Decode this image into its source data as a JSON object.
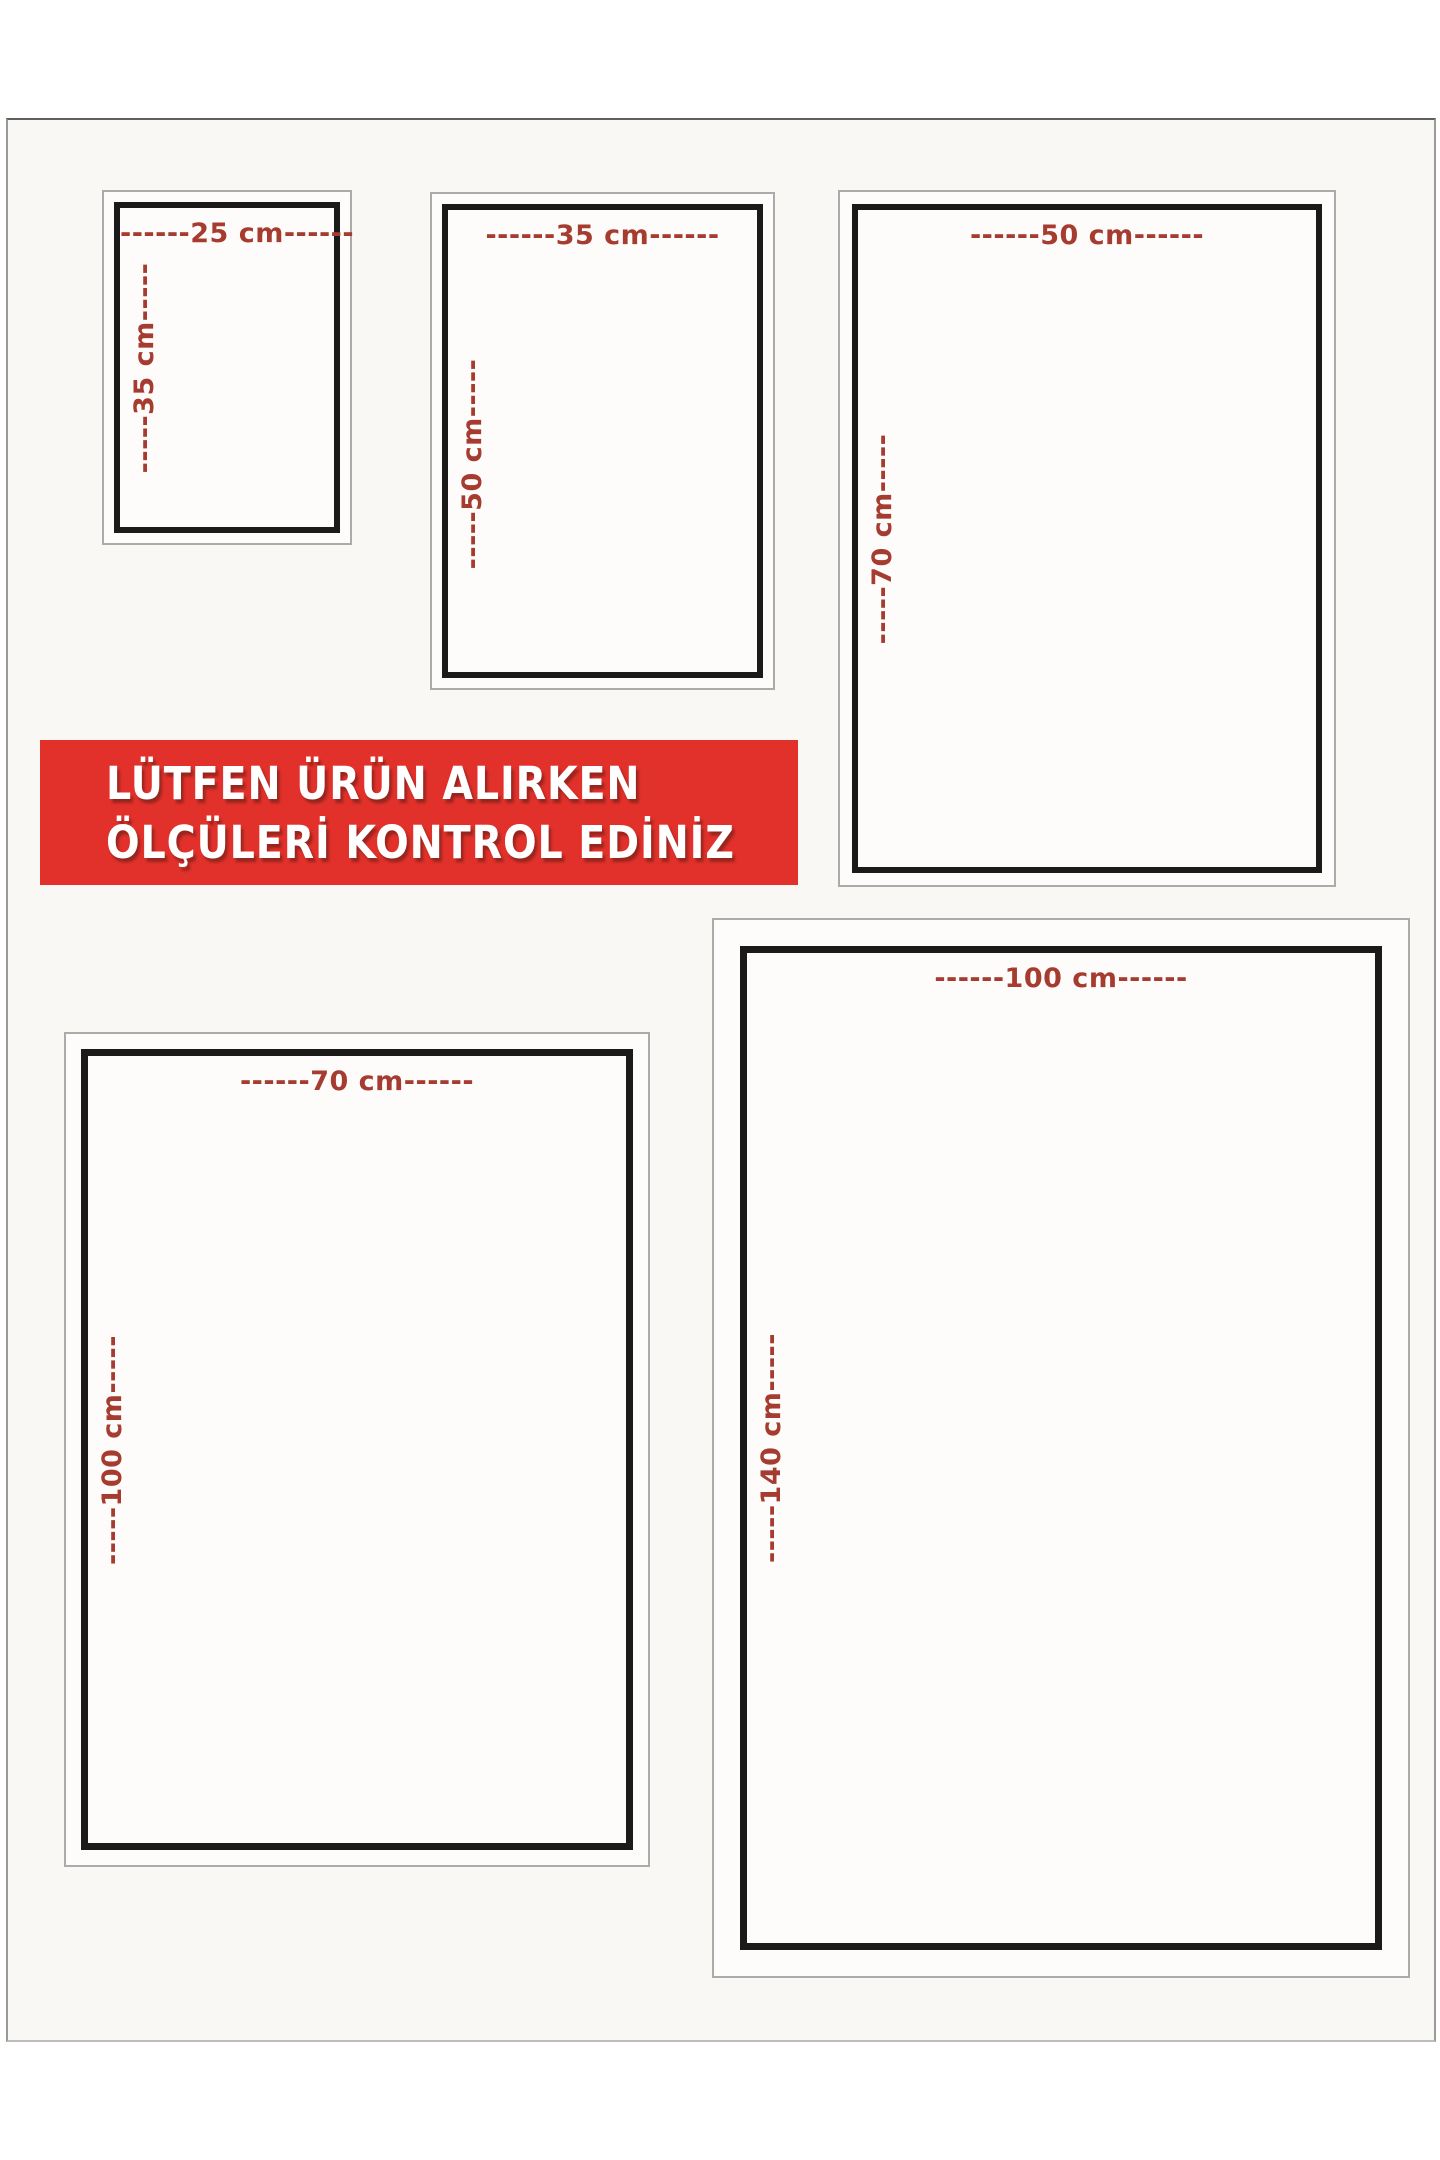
{
  "page": {
    "background": "#ffffff",
    "canvas_background": "#faf8f5"
  },
  "banner": {
    "line1": "LÜTFEN ÜRÜN ALIRKEN",
    "line2": "ÖLÇÜLERİ KONTROL EDİNİZ",
    "background": "#e2312b",
    "text_color": "#ffffff"
  },
  "colors": {
    "dimension_label": "#a63c30",
    "inner_border": "#1a1a1a",
    "outer_border": "#ababab"
  },
  "sizes": [
    {
      "name": "25x35",
      "width_cm": 25,
      "height_cm": 35,
      "width_label": "------25 cm------",
      "height_label": "-----35 cm-----"
    },
    {
      "name": "35x50",
      "width_cm": 35,
      "height_cm": 50,
      "width_label": "------35 cm------",
      "height_label": "-----50 cm-----"
    },
    {
      "name": "50x70",
      "width_cm": 50,
      "height_cm": 70,
      "width_label": "------50 cm------",
      "height_label": "-----70 cm-----"
    },
    {
      "name": "70x100",
      "width_cm": 70,
      "height_cm": 100,
      "width_label": "------70 cm------",
      "height_label": "-----100 cm-----"
    },
    {
      "name": "100x140",
      "width_cm": 100,
      "height_cm": 140,
      "width_label": "------100 cm------",
      "height_label": "-----140 cm-----"
    }
  ]
}
